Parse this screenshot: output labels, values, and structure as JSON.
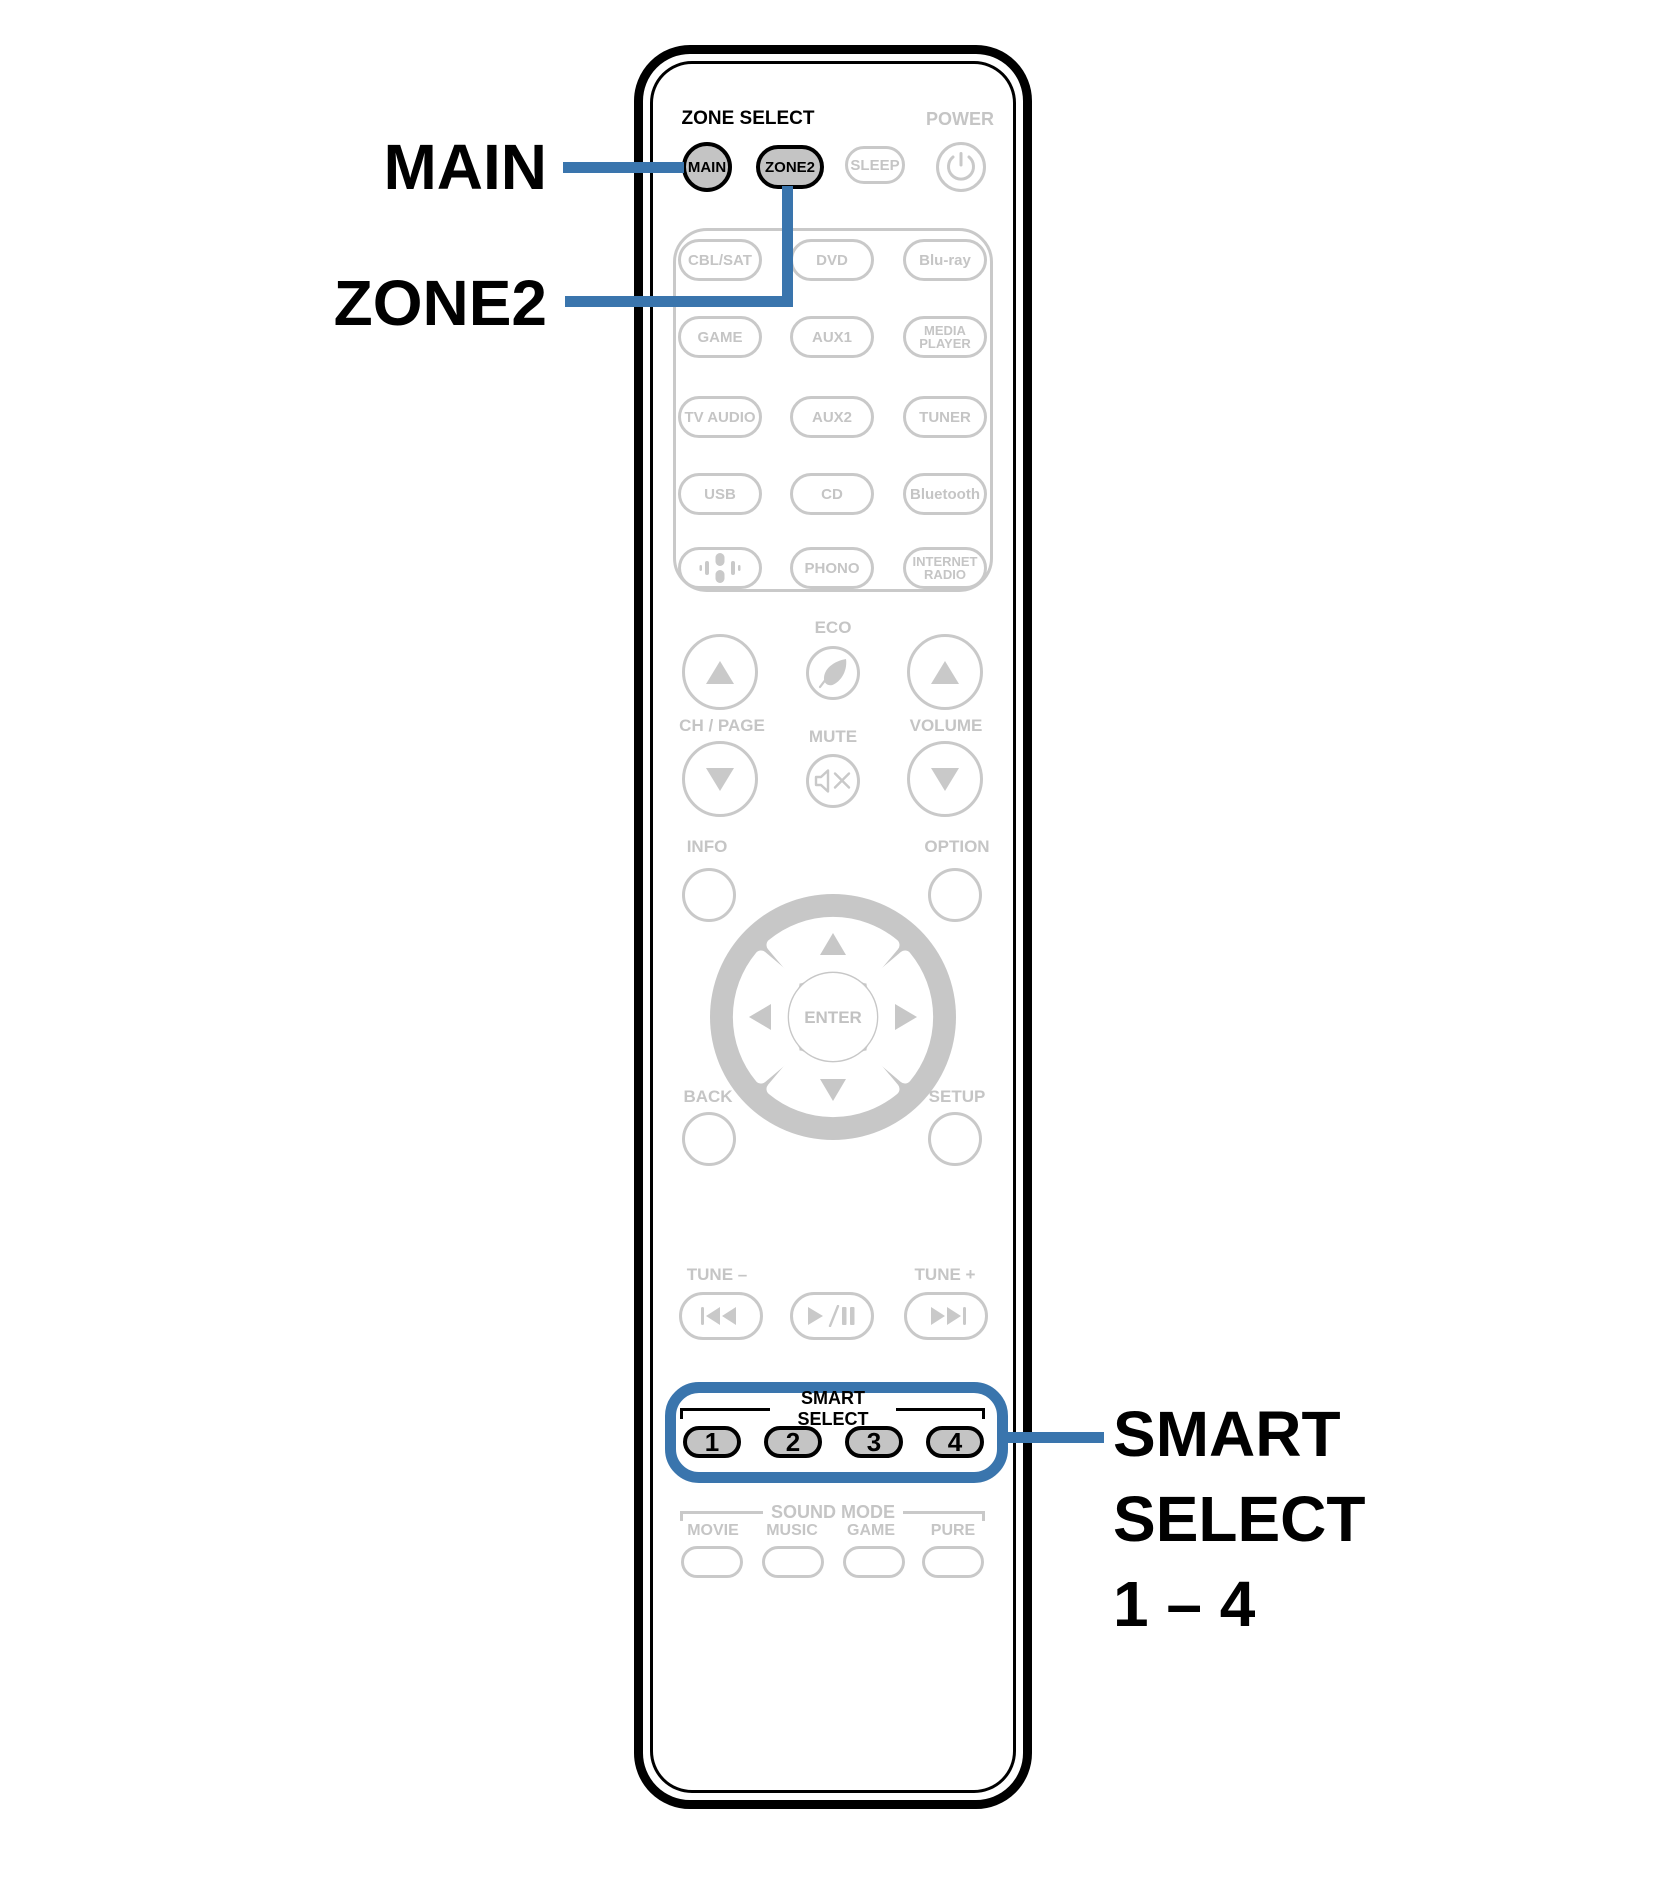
{
  "colors": {
    "accent_blue": "#3A75AD",
    "outline_gray": "#C9C9C9",
    "gray_label": "#C5C5C5",
    "button_fill_gray": "#C4C4C4",
    "dpad_gray": "#C7C7C7",
    "black": "#000000"
  },
  "callouts": {
    "main": "MAIN",
    "zone2": "ZONE2",
    "smart_line1": "SMART",
    "smart_line2": "SELECT",
    "smart_line3": "1 – 4"
  },
  "remote": {
    "header": {
      "zone_select": "ZONE SELECT",
      "power": "POWER"
    },
    "top_buttons": {
      "main": "MAIN",
      "zone2": "ZONE2",
      "sleep": "SLEEP"
    },
    "sources": {
      "r1c1": "CBL/SAT",
      "r1c2": "DVD",
      "r1c3": "Blu-ray",
      "r2c1": "GAME",
      "r2c2": "AUX1",
      "r2c3": "MEDIA PLAYER",
      "r3c1": "TV AUDIO",
      "r3c2": "AUX2",
      "r3c3": "TUNER",
      "r4c1": "USB",
      "r4c2": "CD",
      "r4c3": "Bluetooth",
      "r5c2": "PHONO",
      "r5c3": "INTERNET RADIO"
    },
    "mid": {
      "eco": "ECO",
      "ch_page": "CH / PAGE",
      "mute": "MUTE",
      "volume": "VOLUME",
      "info": "INFO",
      "option": "OPTION",
      "enter": "ENTER",
      "back": "BACK",
      "setup": "SETUP"
    },
    "transport": {
      "tune_minus": "TUNE –",
      "tune_plus": "TUNE +"
    },
    "smart_select": {
      "header": "SMART SELECT",
      "buttons": [
        "1",
        "2",
        "3",
        "4"
      ]
    },
    "sound_mode": {
      "header": "SOUND MODE",
      "labels": [
        "MOVIE",
        "MUSIC",
        "GAME",
        "PURE"
      ]
    }
  }
}
